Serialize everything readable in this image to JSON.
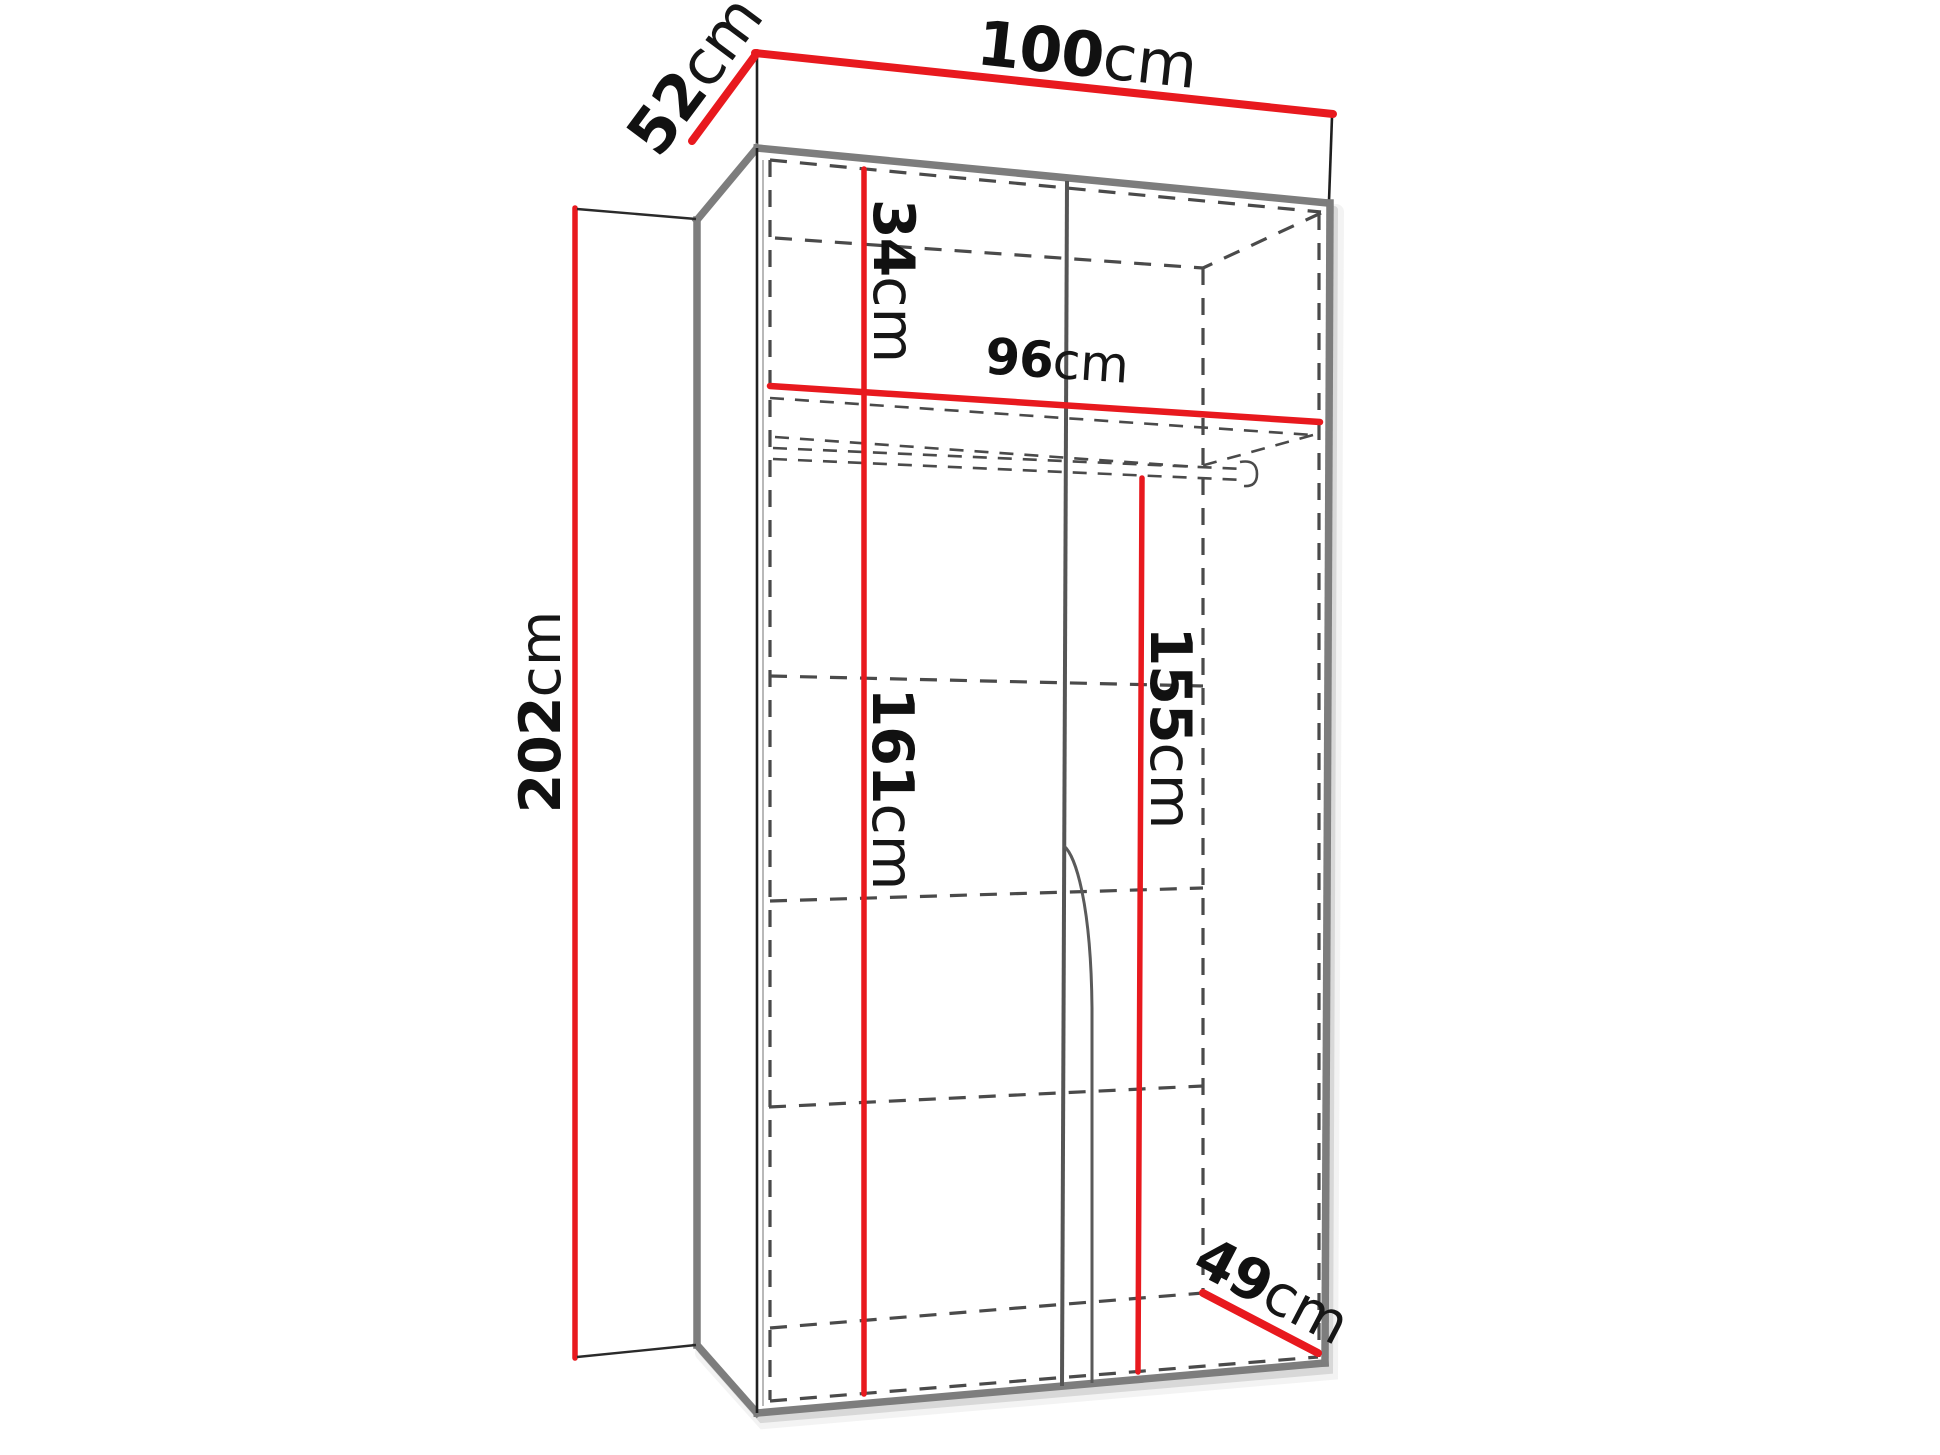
{
  "diagram": {
    "title": "two-door wardrobe dimension diagram",
    "colors": {
      "dimension_red": "#e8191e",
      "edge_gray": "#7d7d7d",
      "dashed_gray": "#4a4a4a",
      "outline_black": "#1f1f1f",
      "background": "#ffffff"
    },
    "dims": {
      "top_width": {
        "value": "100",
        "unit": "cm"
      },
      "top_depth": {
        "value": "52",
        "unit": "cm"
      },
      "height": {
        "value": "202",
        "unit": "cm"
      },
      "top_section": {
        "value": "34",
        "unit": "cm"
      },
      "inner_width": {
        "value": "96",
        "unit": "cm"
      },
      "left_inner_height": {
        "value": "161",
        "unit": "cm"
      },
      "hanging_height": {
        "value": "155",
        "unit": "cm"
      },
      "bottom_depth": {
        "value": "49",
        "unit": "cm"
      }
    }
  }
}
